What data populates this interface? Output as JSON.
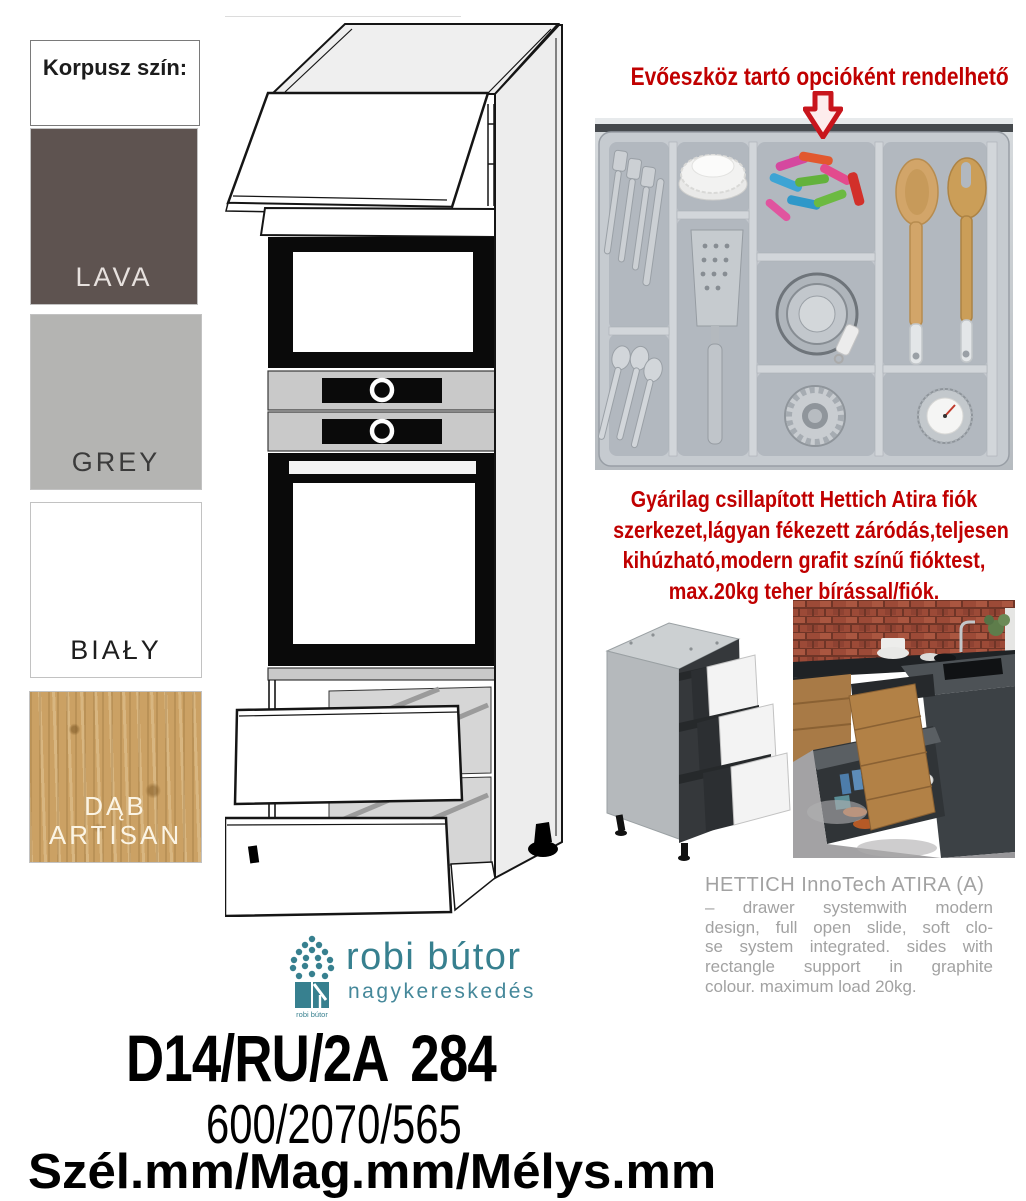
{
  "panel": {
    "title": "Korpusz szín:",
    "swatches": [
      {
        "label": "LAVA",
        "bg": "#5e5350",
        "fg": "#e7e1de"
      },
      {
        "label": "GREY",
        "bg": "#b4b4b2",
        "fg": "#3b3b3b"
      },
      {
        "label": "BIAŁY",
        "bg": "#ffffff",
        "fg": "#1e1e1e"
      },
      {
        "label": "DĄB ARTISAN",
        "bg": "#cba164",
        "fg": "#fbf4e4"
      }
    ]
  },
  "cutlery_option": {
    "headline": "Evőeszköz tartó opcióként rendelhető",
    "color": "#c00000",
    "arrow_icon": "down-block-arrow"
  },
  "drawer_note_red": {
    "color": "#c00000",
    "lines": [
      "Gyárilag csillapított Hettich Atira fiók",
      "szerkezet,lágyan fékezett záródás,teljesen",
      "kihúzható,modern grafit színű fióktest,",
      "max.20kg teher bírással/fiók."
    ]
  },
  "hettich_note": {
    "color": "#a2a2a2",
    "title": "HETTICH InnoTech ATIRA (A)",
    "lines": [
      "– drawer systemwith modern",
      "design, full open slide, soft clo-",
      "se system integrated. sides with",
      "rectangle support in graphite",
      "colour. maximum load 20kg."
    ]
  },
  "logo": {
    "brand": "robi bútor",
    "subtitle": "nagykereskedés",
    "icon_caption": "robi bútor",
    "color": "#37808f",
    "subtitle_color": "#45889a"
  },
  "product": {
    "code": "D14/RU/2A 284",
    "dimensions": "600/2070/565",
    "dimension_labels": "Szél.mm/Mag.mm/Mélys.mm"
  }
}
